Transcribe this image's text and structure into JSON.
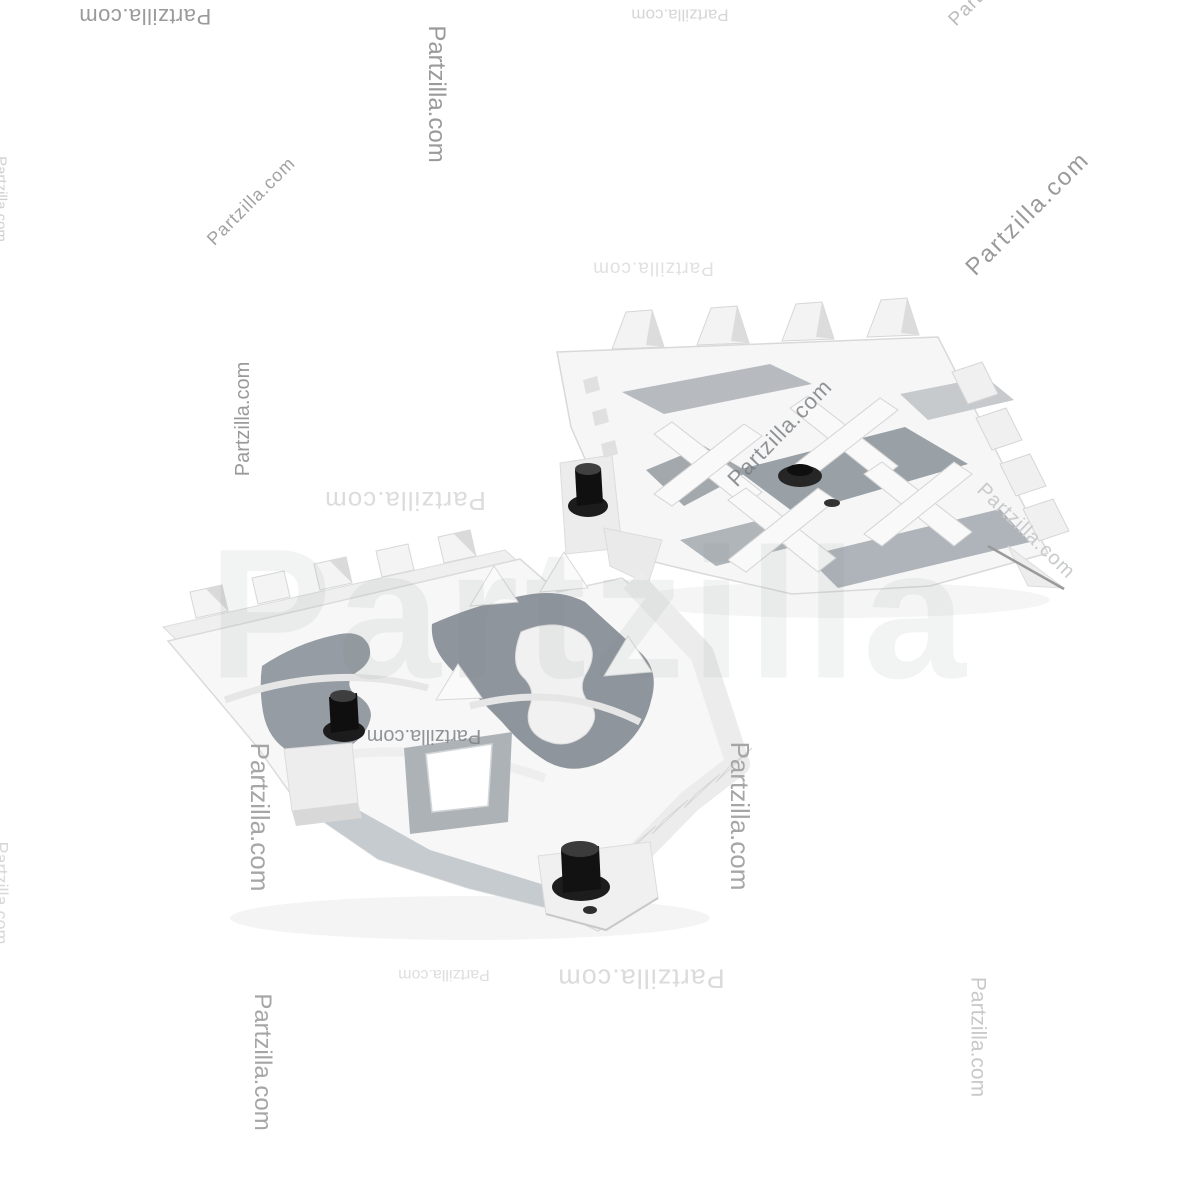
{
  "image": {
    "background_color": "#ffffff",
    "subject": "pair of white serrated footpeg brackets with black mounting bolts and flange nuts",
    "colors": {
      "part_white": "#f6f6f6",
      "part_edge": "#d9d9d9",
      "pocket_gray": "#99a0a6",
      "hardware_black": "#1c1c1c"
    }
  },
  "watermark": {
    "text": "Partzilla.com",
    "giant_text": "Partzilla",
    "count": 20,
    "color_strong": "#9a9a9a",
    "color_faint": "#dadada"
  }
}
